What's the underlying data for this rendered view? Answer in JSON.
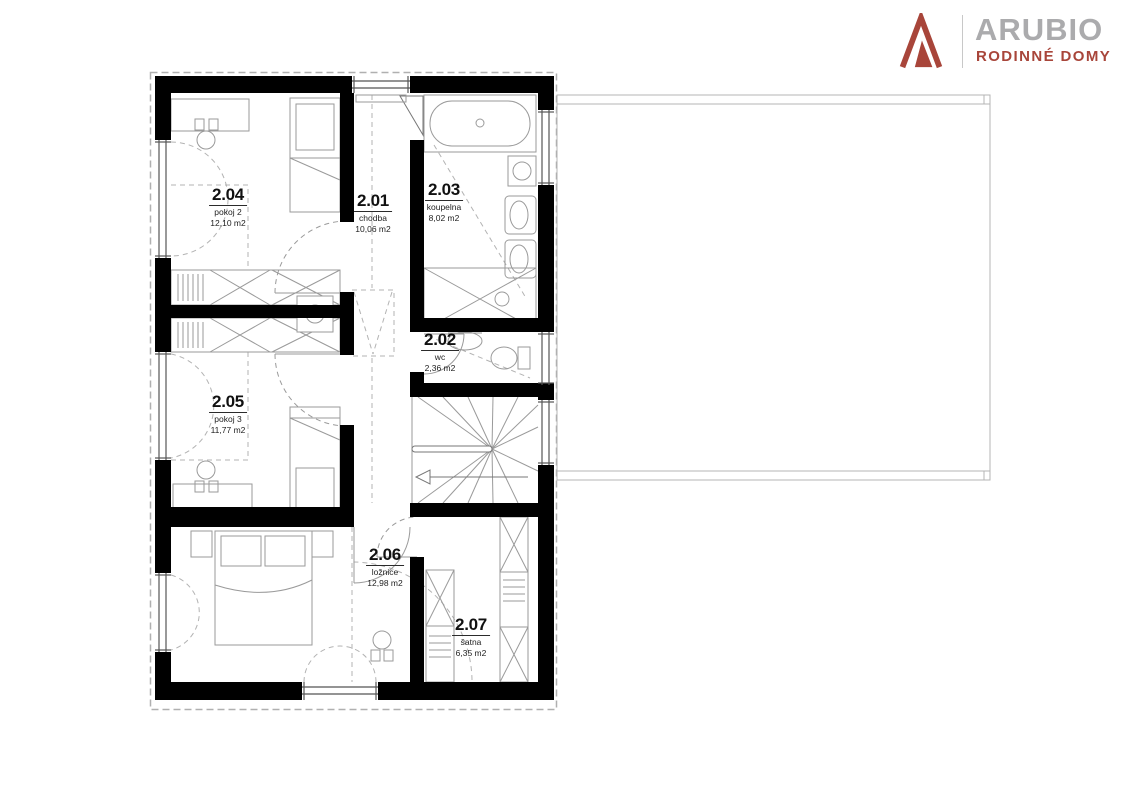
{
  "brand": {
    "name": "ARUBIO",
    "tagline": "RODINNÉ DOMY",
    "name_color": "#ABABAD",
    "accent_color": "#A8453A"
  },
  "floor_plan": {
    "wall_color": "#000000",
    "rooms": [
      {
        "number": "2.01",
        "name": "chodba",
        "area": "10,06 m2"
      },
      {
        "number": "2.02",
        "name": "wc",
        "area": "2,36 m2"
      },
      {
        "number": "2.03",
        "name": "koupelna",
        "area": "8,02 m2"
      },
      {
        "number": "2.04",
        "name": "pokoj 2",
        "area": "12,10 m2"
      },
      {
        "number": "2.05",
        "name": "pokoj 3",
        "area": "11,77 m2"
      },
      {
        "number": "2.06",
        "name": "ložnice",
        "area": "12,98 m2"
      },
      {
        "number": "2.07",
        "name": "šatna",
        "area": "6,35 m2"
      }
    ]
  }
}
